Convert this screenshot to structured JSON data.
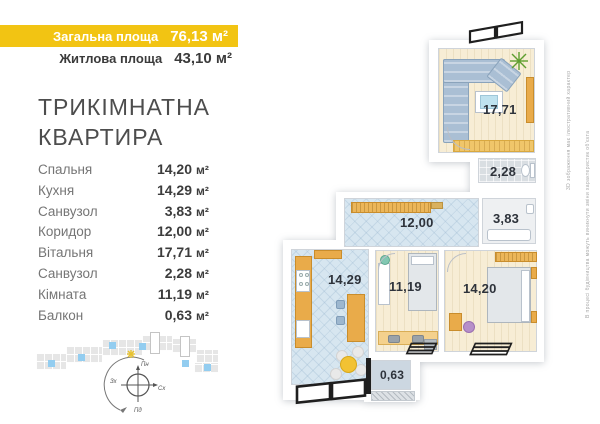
{
  "unit": "м²",
  "header": {
    "total_label": "Загальна площа",
    "total_value": "76,13",
    "living_label": "Житлова площа",
    "living_value": "43,10",
    "bar_color": "#f2c413"
  },
  "title": {
    "line1": "ТРИКІМНАТНА",
    "line2": "КВАРТИРА"
  },
  "rooms": [
    {
      "label": "Спальня",
      "value": "14,20"
    },
    {
      "label": "Кухня",
      "value": "14,29"
    },
    {
      "label": "Санвузол",
      "value": "3,83"
    },
    {
      "label": "Коридор",
      "value": "12,00"
    },
    {
      "label": "Вітальня",
      "value": "17,71"
    },
    {
      "label": "Санвузол",
      "value": "2,28"
    },
    {
      "label": "Кімната",
      "value": "11,19"
    },
    {
      "label": "Балкон",
      "value": "0,63"
    }
  ],
  "plan": {
    "living": "17,71",
    "wc_top": "2,28",
    "corridor": "12,00",
    "bathroom": "3,83",
    "kitchen": "14,29",
    "room": "11,19",
    "bedroom": "14,20",
    "balcony": "0,63",
    "floor_colors": {
      "cream": "#f7edd5",
      "tile_blue": "#d7e6f0",
      "tile_gray": "#d9dee2",
      "balcony": "#ccd7e1"
    }
  },
  "disclaimer": {
    "line1": "3D зображення має ілюстративний характер",
    "line2": "В процесі будівництва можуть виникнути зміни характеристик об'єкта"
  },
  "compass": {
    "n": "Пн",
    "s": "Пд",
    "e": "Сх",
    "w": "Зх"
  },
  "site_plan": {
    "colors": {
      "g": "#e6e6e6",
      "b": "#93cdf0",
      "o": "#ffffff"
    },
    "blocks": [
      {
        "x": 28,
        "y": 24,
        "w": 30,
        "h": 16,
        "t": "g"
      },
      {
        "x": 58,
        "y": 17,
        "w": 36,
        "h": 16,
        "t": "g"
      },
      {
        "x": 94,
        "y": 10,
        "w": 40,
        "h": 16,
        "t": "g"
      },
      {
        "x": 134,
        "y": 6,
        "w": 30,
        "h": 15,
        "t": "g"
      },
      {
        "x": 164,
        "y": 9,
        "w": 24,
        "h": 14,
        "t": "g"
      },
      {
        "x": 188,
        "y": 20,
        "w": 22,
        "h": 13,
        "t": "g"
      },
      {
        "x": 186,
        "y": 33,
        "w": 24,
        "h": 10,
        "t": "g"
      },
      {
        "x": 142,
        "y": 2,
        "w": 10,
        "h": 22,
        "t": "o"
      },
      {
        "x": 172,
        "y": 6,
        "w": 10,
        "h": 21,
        "t": "o"
      },
      {
        "x": 40,
        "y": 30,
        "w": 7,
        "h": 7,
        "t": "b"
      },
      {
        "x": 70,
        "y": 24,
        "w": 7,
        "h": 7,
        "t": "b"
      },
      {
        "x": 101,
        "y": 12,
        "w": 7,
        "h": 7,
        "t": "b"
      },
      {
        "x": 131,
        "y": 13,
        "w": 7,
        "h": 7,
        "t": "b"
      },
      {
        "x": 174,
        "y": 30,
        "w": 7,
        "h": 7,
        "t": "b"
      },
      {
        "x": 196,
        "y": 34,
        "w": 7,
        "h": 7,
        "t": "b"
      }
    ]
  }
}
